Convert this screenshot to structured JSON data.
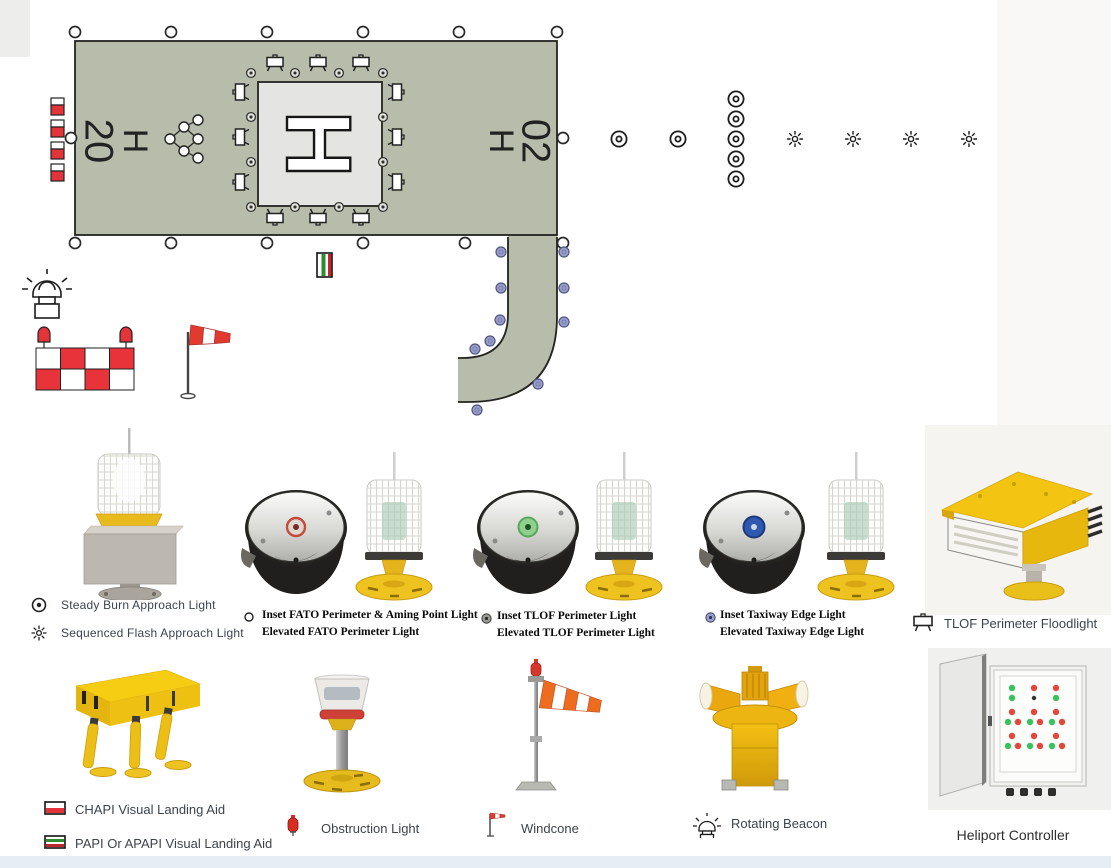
{
  "diagram": {
    "heading_left": "20",
    "heading_left_h": "H",
    "heading_right_h": "H",
    "heading_right": "02",
    "tlof_marking": "H"
  },
  "legend_row1": {
    "steady_burn": "Steady Burn Approach Light",
    "sequenced_flash": "Sequenced Flash Approach Light",
    "inset_fato": "Inset FATO Perimeter & Aming Point Light",
    "elevated_fato": "Elevated FATO Perimeter Light",
    "inset_tlof": "Inset TLOF Perimeter Light",
    "elevated_tlof": "Elevated TLOF Perimeter Light",
    "inset_taxiway": "Inset Taxiway Edge Light",
    "elevated_taxiway": "Elevated Taxiway Edge Light",
    "tlof_floodlight": "TLOF Perimeter Floodlight"
  },
  "legend_row2": {
    "chapi": "CHAPI Visual Landing Aid",
    "papi": "PAPI Or APAPI Visual Landing Aid",
    "obstruction": "Obstruction Light",
    "windcone": "Windcone",
    "rotating_beacon": "Rotating Beacon",
    "heliport_controller": "Heliport Controller"
  },
  "icons": {
    "steady_burn": "steady-burn-approach-light-icon",
    "sequenced_flash": "sequenced-flash-approach-light-icon",
    "inset_fato": "inset-fato-light-icon",
    "inset_tlof": "inset-tlof-light-icon",
    "inset_taxiway": "inset-taxiway-light-icon",
    "floodlight": "floodlight-symbol-icon",
    "chapi": "chapi-bar-icon",
    "papi": "papi-bar-icon",
    "obstruction": "obstruction-light-icon",
    "windcone": "windsock-icon",
    "rotating_beacon": "rotating-beacon-icon"
  },
  "colors": {
    "fato_surface": "#b7bcab",
    "tlof_surface": "#e4e4e2",
    "marking_red": "#e3343a",
    "taxiway_light_blue": "#9aa0cb",
    "product_yellow": "#eebc1c",
    "windsock_orange": "#ee6c1d",
    "status_green": "#39c15c",
    "status_red": "#e2473c",
    "label_text": "#3d434e"
  }
}
